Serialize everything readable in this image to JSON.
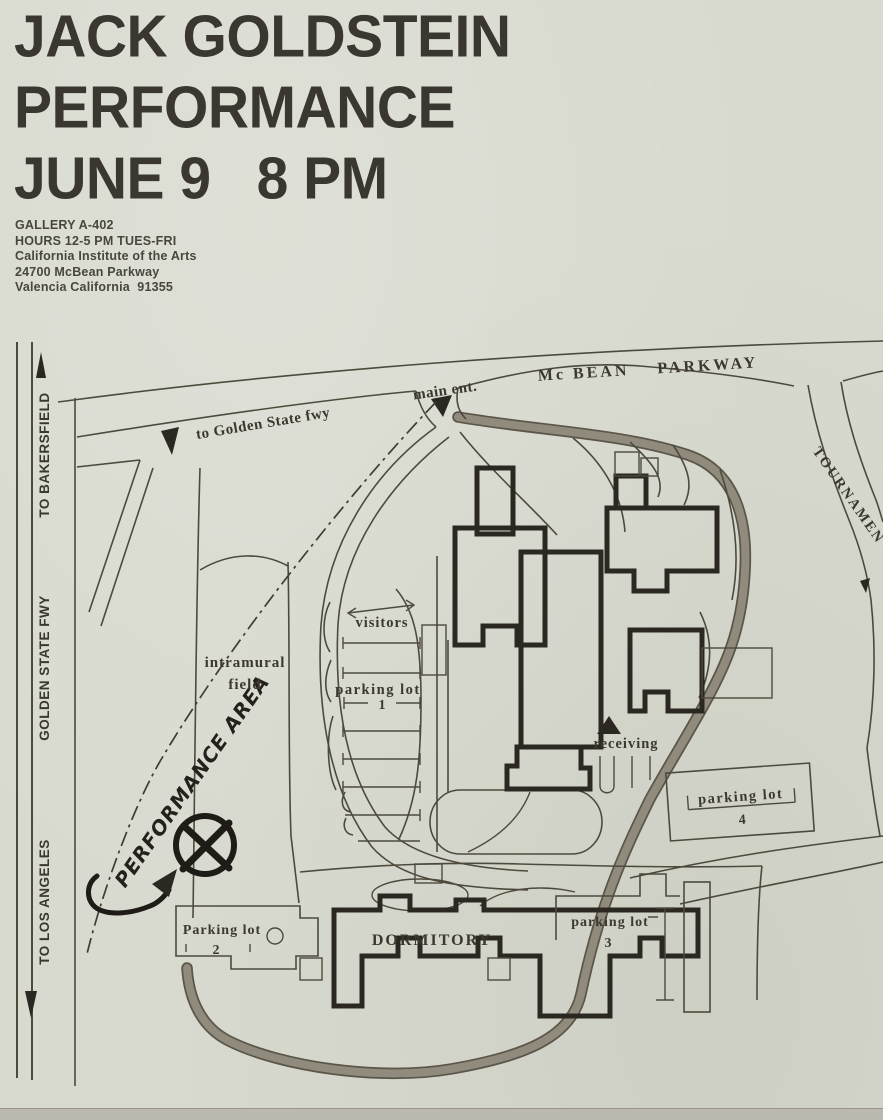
{
  "poster": {
    "title_lines": [
      "JACK GOLDSTEIN",
      "PERFORMANCE",
      "JUNE 9   8 PM"
    ],
    "info_lines": [
      "GALLERY A-402",
      "HOURS 12-5 PM TUES-FRI",
      "California Institute of the Arts",
      "24700 McBean Parkway",
      "Valencia California  91355"
    ]
  },
  "map": {
    "highway_labels": {
      "to_bakersfield": "TO BAKERSFIELD",
      "golden_state_fwy": "GOLDEN STATE FWY",
      "to_los_angeles": "TO LOS ANGELES"
    },
    "road_labels": {
      "mcbean_parkway": "Mc BEAN    PARKWAY",
      "main_entrance": "main ent.",
      "to_golden_state": "to Golden State fwy",
      "tournament": "TOURNAMEN"
    },
    "place_labels": {
      "intramural_line1": "intramural",
      "intramural_line2": "field",
      "visitors": "visitors",
      "dormitory": "DORMITORY",
      "receiving": "receiving"
    },
    "parking": {
      "lot1_label": "parking lot",
      "lot1_num": "1",
      "lot2_label": "Parking lot",
      "lot2_num": "2",
      "lot3_label": "parking lot",
      "lot3_num": "3",
      "lot4_label": "parking lot",
      "lot4_num": "4"
    },
    "annotations": {
      "performance_area": "PERFORMANCE AREA"
    },
    "colors": {
      "paper": "#d8dacf",
      "ink": "#3c382e",
      "building": "#2b2822",
      "shaded_road": "#918b7d"
    }
  }
}
